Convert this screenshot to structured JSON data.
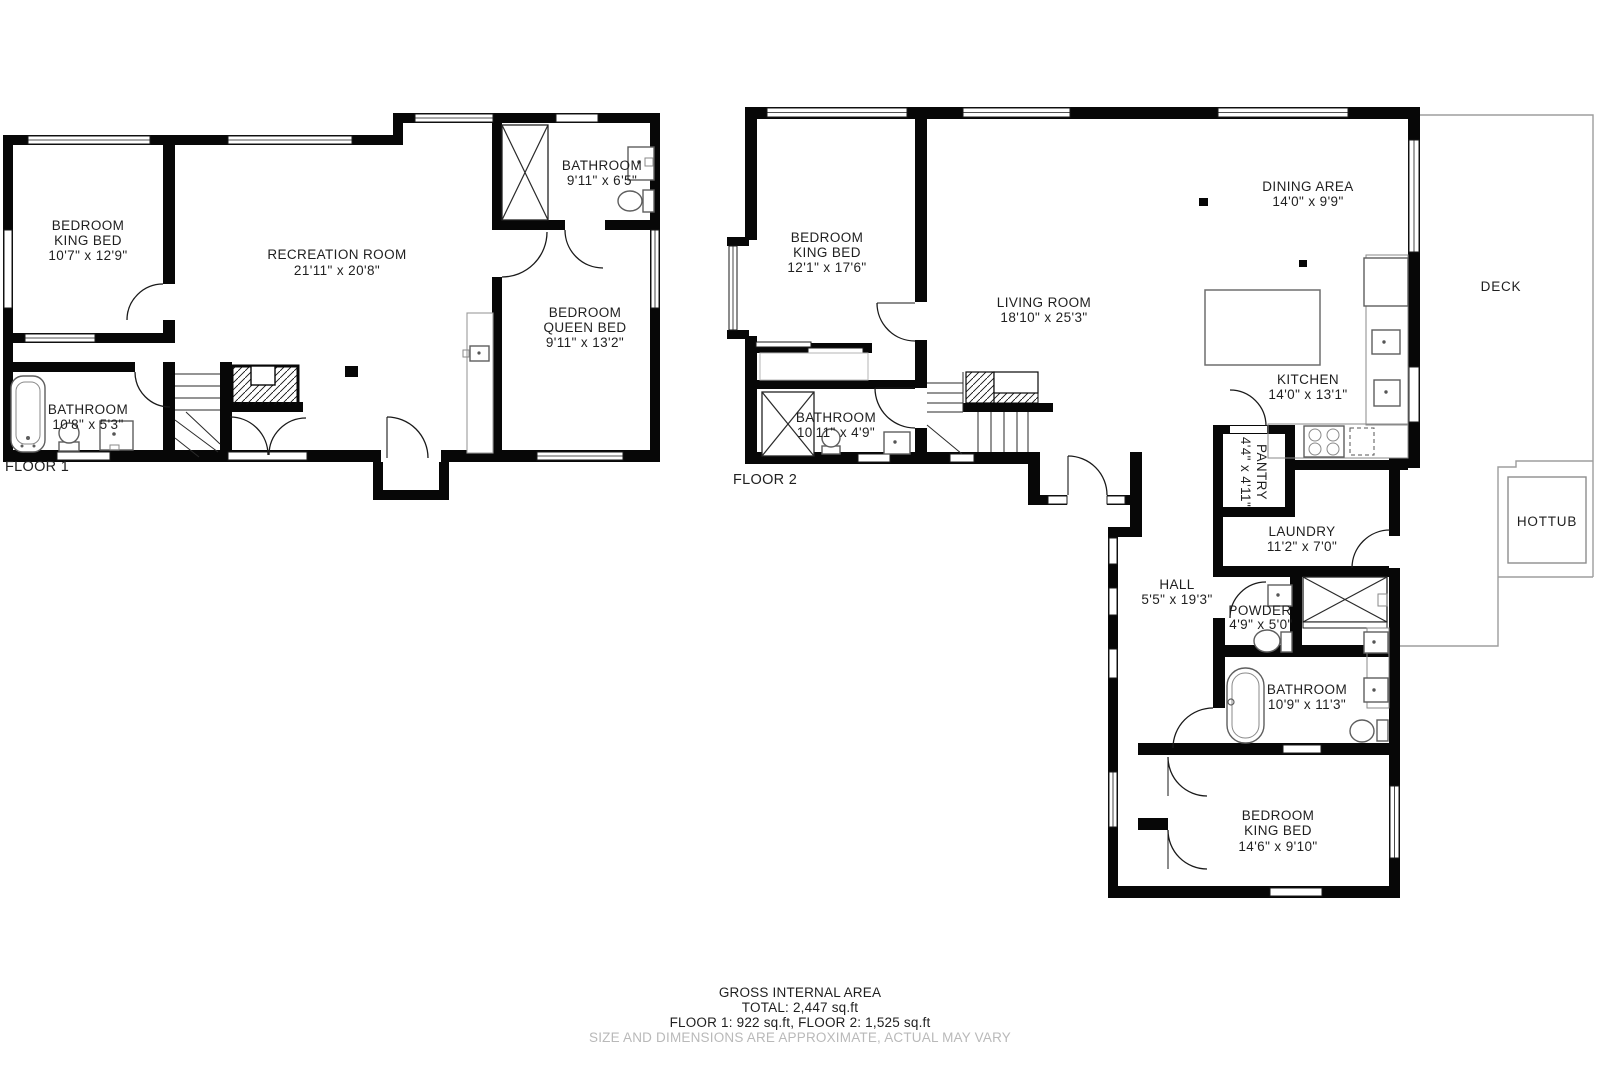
{
  "floor1": {
    "label": "FLOOR 1",
    "rooms": [
      {
        "id": "bedroom-king",
        "lines": [
          "BEDROOM",
          "KING BED",
          "10'7\" x 12'9\""
        ]
      },
      {
        "id": "recreation-room",
        "lines": [
          "RECREATION ROOM",
          "21'11\" x 20'8\""
        ]
      },
      {
        "id": "bathroom-upper",
        "lines": [
          "BATHROOM",
          "9'11\" x 6'5\""
        ]
      },
      {
        "id": "bedroom-queen",
        "lines": [
          "BEDROOM",
          "QUEEN BED",
          "9'11\" x 13'2\""
        ]
      },
      {
        "id": "bathroom-lower",
        "lines": [
          "BATHROOM",
          "10'8\" x 5'3\""
        ]
      }
    ]
  },
  "floor2": {
    "label": "FLOOR 2",
    "rooms": [
      {
        "id": "bedroom-king-2",
        "lines": [
          "BEDROOM",
          "KING BED",
          "12'1\" x 17'6\""
        ]
      },
      {
        "id": "living-room",
        "lines": [
          "LIVING ROOM",
          "18'10\" x 25'3\""
        ]
      },
      {
        "id": "dining-area",
        "lines": [
          "DINING AREA",
          "14'0\" x 9'9\""
        ]
      },
      {
        "id": "kitchen",
        "lines": [
          "KITCHEN",
          "14'0\" x 13'1\""
        ]
      },
      {
        "id": "bathroom-small",
        "lines": [
          "BATHROOM",
          "10'11\" x 4'9\""
        ]
      },
      {
        "id": "pantry",
        "lines": [
          "PANTRY",
          "4'4\" x 4'11\""
        ]
      },
      {
        "id": "laundry",
        "lines": [
          "LAUNDRY",
          "11'2\" x 7'0\""
        ]
      },
      {
        "id": "hall",
        "lines": [
          "HALL",
          "5'5\" x 19'3\""
        ]
      },
      {
        "id": "powder",
        "lines": [
          "POWDER",
          "4'9\" x 5'0\""
        ]
      },
      {
        "id": "bathroom-main",
        "lines": [
          "BATHROOM",
          "10'9\" x 11'3\""
        ]
      },
      {
        "id": "bedroom-bottom",
        "lines": [
          "BEDROOM",
          "KING BED",
          "14'6\" x 9'10\""
        ]
      }
    ]
  },
  "outdoor": {
    "deck": "DECK",
    "hottub": "HOTTUB"
  },
  "footer": {
    "line1": "GROSS INTERNAL AREA",
    "line2": "TOTAL: 2,447 sq.ft",
    "line3": "FLOOR 1: 922 sq.ft, FLOOR 2: 1,525 sq.ft",
    "line4": "SIZE AND DIMENSIONS ARE APPROXIMATE, ACTUAL MAY VARY"
  }
}
